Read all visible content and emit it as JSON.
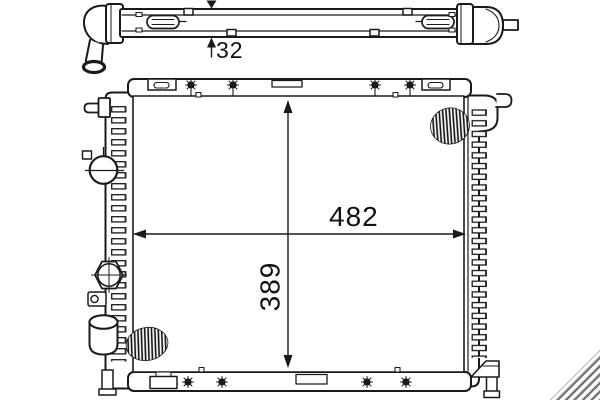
{
  "canvas": {
    "background": "#ffffff",
    "line_color": "#1a1a1a"
  },
  "top_view": {
    "depth_label": "32"
  },
  "front_view": {
    "width_label": "482",
    "height_label": "389"
  },
  "watermark": {
    "stripe_color": "#6b6b6b"
  }
}
